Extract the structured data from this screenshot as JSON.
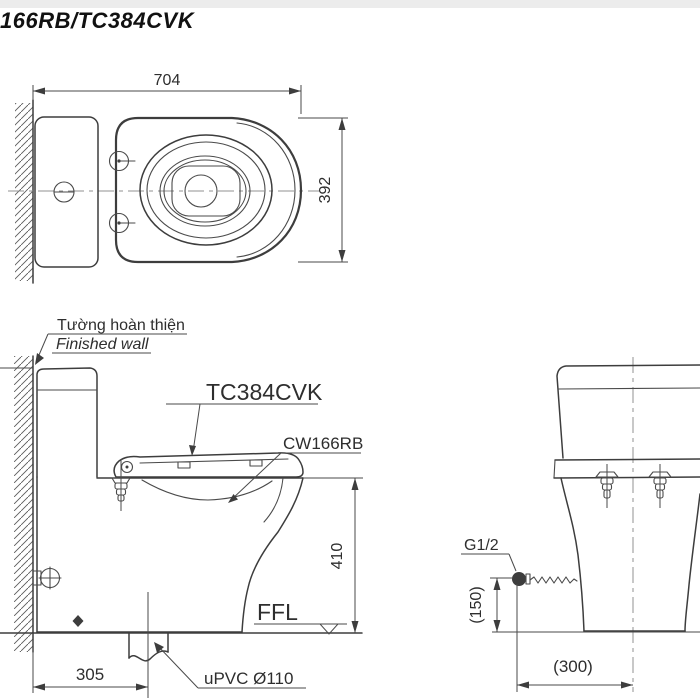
{
  "title": "166RB/TC384CVK",
  "top_view": {
    "width_mm": "704",
    "depth_mm": "392"
  },
  "side_view": {
    "wall_label_vi": "Tường hoàn thiện",
    "wall_label_en": "Finished wall",
    "seat_model": "TC384CVK",
    "bowl_model": "CW166RB",
    "height_mm": "410",
    "outlet_offset_mm": "305",
    "floor_level_label": "FFL",
    "drain_pipe_label": "uPVC Ø110"
  },
  "front_view": {
    "water_supply_thread": "G1/2",
    "supply_height_mm": "(150)",
    "supply_offset_mm": "(300)"
  },
  "colors": {
    "line": "#3d3d3d",
    "text": "#2e2e2e",
    "centerline": "#909090",
    "background": "#ffffff",
    "top_strip": "#ececec"
  }
}
